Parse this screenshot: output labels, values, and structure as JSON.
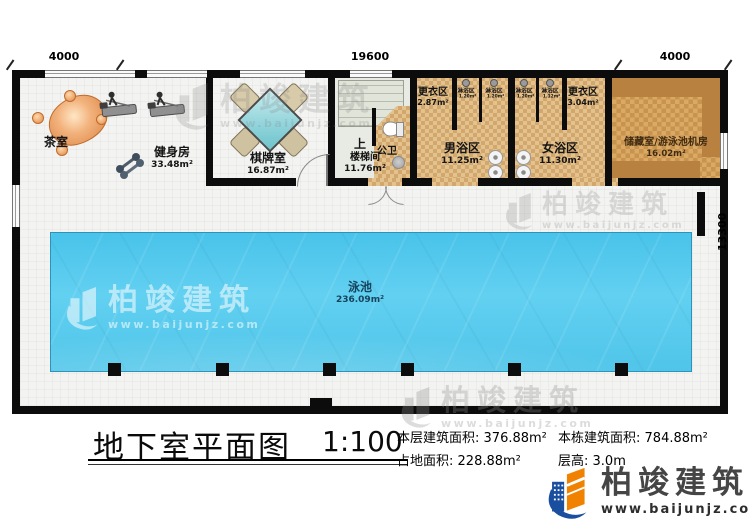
{
  "title": {
    "text": "地下室平面图",
    "scale": "1:100"
  },
  "dimensions": {
    "top_left": "4000",
    "top_center": "19600",
    "top_right": "4000",
    "right_side": "13300"
  },
  "rooms": {
    "tea_room": {
      "name": "茶室"
    },
    "gym": {
      "name": "健身房",
      "area": "33.48m²"
    },
    "game_room": {
      "name": "棋牌室",
      "area": "16.87m²"
    },
    "stairwell": {
      "direction": "上",
      "name": "楼梯间",
      "area": "11.76m²"
    },
    "public_toilet": {
      "name": "公卫"
    },
    "changing_male": {
      "name": "更衣区",
      "area": "2.87m²"
    },
    "changing_female": {
      "name": "更衣区",
      "area": "3.04m²"
    },
    "bath_male": {
      "name": "男浴区",
      "area": "11.25m²"
    },
    "bath_female": {
      "name": "女浴区",
      "area": "11.30m²"
    },
    "showers": [
      {
        "name": "淋浴区",
        "area": "1.20m²"
      },
      {
        "name": "淋浴区",
        "area": "1.20m²"
      },
      {
        "name": "淋浴区",
        "area": "1.20m²"
      },
      {
        "name": "淋浴区",
        "area": "1.12m²"
      }
    ],
    "storage": {
      "name": "储藏室/游泳池机房",
      "area": "16.02m²"
    },
    "pool": {
      "name": "泳池",
      "area": "236.09m²"
    }
  },
  "stats": {
    "floor_area_label": "本层建筑面积:",
    "floor_area_value": "376.88m²",
    "total_area_label": "本栋建筑面积:",
    "total_area_value": "784.88m²",
    "land_area_label": "占地面积:",
    "land_area_value": "228.88m²",
    "height_label": "层高:",
    "height_value": "3.0m"
  },
  "brand": {
    "name": "柏竣建筑",
    "url": "www.baijunjz.com"
  },
  "colors": {
    "pool_water": "#55c9ec",
    "bath_floor": "#ddb784",
    "storage_band": "#b98140",
    "brand_blue": "#1a4e9e",
    "brand_orange": "#f08200"
  }
}
